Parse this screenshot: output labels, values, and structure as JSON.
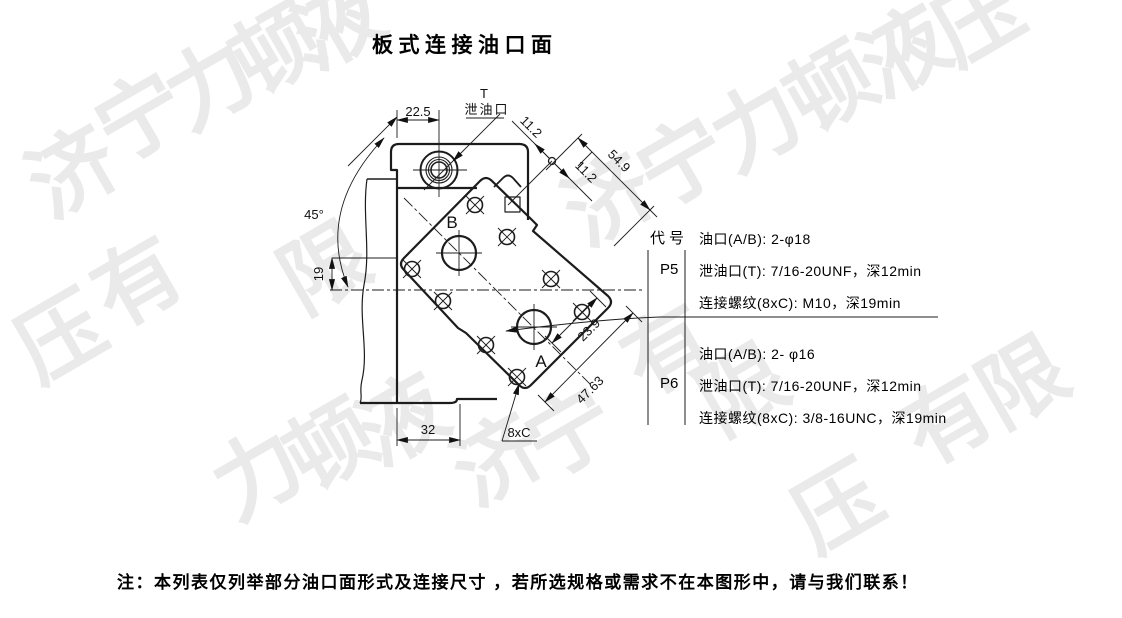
{
  "title": "板式连接油口面",
  "drawing": {
    "labels": {
      "t": "T",
      "drain": "泄油口",
      "port_b": "B",
      "port_a": "A",
      "bolts": "8xC"
    },
    "dims": {
      "w22": "22.5",
      "a45": "45°",
      "h19": "19",
      "w32": "32",
      "c11a": "11.2",
      "c11b": "11.2",
      "d549": "54.9",
      "d239": "23.9",
      "d4763": "47.63"
    }
  },
  "table": {
    "header": "代号",
    "rows": [
      {
        "code": "P5",
        "l1": "油口(A/B): 2-φ18",
        "l2": "泄油口(T): 7/16-20UNF，深12min",
        "l3": "连接螺纹(8xC): M10，深19min"
      },
      {
        "code": "P6",
        "l1": "油口(A/B): 2- φ16",
        "l2": "泄油口(T): 7/16-20UNF，深12min",
        "l3": "连接螺纹(8xC): 3/8-16UNC，深19min"
      }
    ]
  },
  "note": "注：本列表仅列举部分油口面形式及连接尺寸 ，若所选规格或需求不在本图形中，请与我们联系！",
  "watermark": {
    "color": "#eaeaea",
    "items": [
      {
        "c": "济",
        "x": 30,
        "y": 130
      },
      {
        "c": "宁",
        "x": 98,
        "y": 75
      },
      {
        "c": "力",
        "x": 168,
        "y": 42
      },
      {
        "c": "顿",
        "x": 234,
        "y": 8
      },
      {
        "c": "液",
        "x": 296,
        "y": -18
      },
      {
        "c": "济",
        "x": 566,
        "y": 158
      },
      {
        "c": "宁",
        "x": 640,
        "y": 120
      },
      {
        "c": "力",
        "x": 714,
        "y": 84
      },
      {
        "c": "顿",
        "x": 788,
        "y": 46
      },
      {
        "c": "液",
        "x": 862,
        "y": 10
      },
      {
        "c": "压",
        "x": 936,
        "y": -22
      },
      {
        "c": "压",
        "x": 18,
        "y": 295
      },
      {
        "c": "有",
        "x": 95,
        "y": 240
      },
      {
        "c": "限",
        "x": 282,
        "y": 226
      },
      {
        "c": "力",
        "x": 215,
        "y": 432
      },
      {
        "c": "顿",
        "x": 288,
        "y": 404
      },
      {
        "c": "液",
        "x": 360,
        "y": 378
      },
      {
        "c": "济",
        "x": 455,
        "y": 418
      },
      {
        "c": "宁",
        "x": 528,
        "y": 390
      },
      {
        "c": "有",
        "x": 625,
        "y": 308
      },
      {
        "c": "限",
        "x": 700,
        "y": 348
      },
      {
        "c": "有",
        "x": 905,
        "y": 378
      },
      {
        "c": "限",
        "x": 980,
        "y": 340
      },
      {
        "c": "压",
        "x": 795,
        "y": 465
      }
    ]
  }
}
